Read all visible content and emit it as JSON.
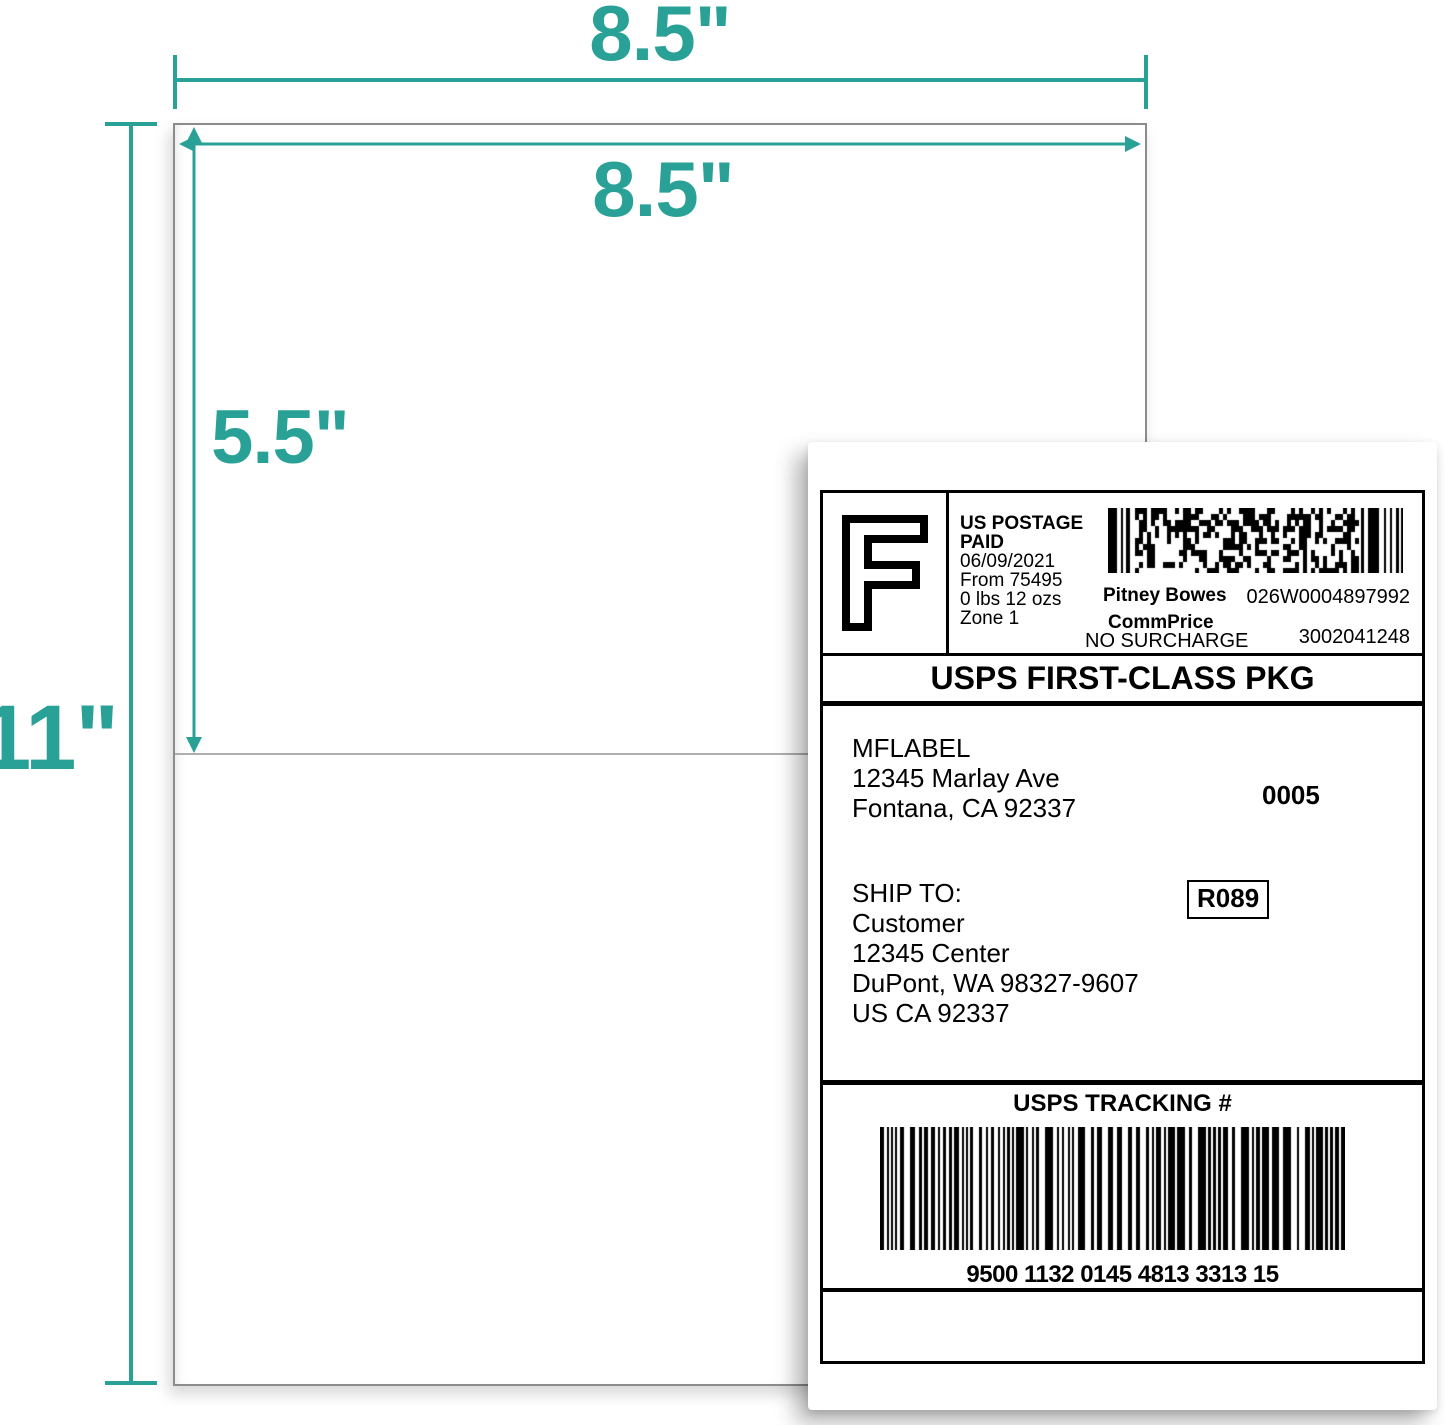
{
  "colors": {
    "accent": "#2aa196",
    "sheet_border": "#8c8c8c",
    "perforation": "#aeaeae"
  },
  "dimensions": {
    "sheet_width": "8.5\"",
    "label_width": "8.5\"",
    "label_height": "5.5\"",
    "sheet_height": "11\""
  },
  "shipping_label": {
    "indicia": {
      "letter": "F",
      "lines": [
        "US POSTAGE",
        "PAID",
        "06/09/2021",
        "From 75495",
        "0 lbs 12 ozs",
        "Zone 1"
      ]
    },
    "meter": {
      "vendor": "Pitney Bowes",
      "meter_number": "026W0004897992",
      "rate": "CommPrice",
      "surcharge": "NO SURCHARGE",
      "account": "3002041248"
    },
    "service": "USPS FIRST-CLASS PKG",
    "sender": {
      "name": "MFLABEL",
      "street": "12345 Marlay Ave",
      "city_state_zip": "Fontana, CA 92337"
    },
    "batch_number": "0005",
    "ship_to_heading": "SHIP TO:",
    "recipient": {
      "name": "Customer",
      "street": "12345 Center",
      "city_state_zip": "DuPont, WA 98327-9607",
      "country_line": "US CA 92337"
    },
    "route_code": "R089",
    "tracking": {
      "heading": "USPS TRACKING #",
      "number": "9500 1132 0145 4813 3313 15"
    }
  }
}
